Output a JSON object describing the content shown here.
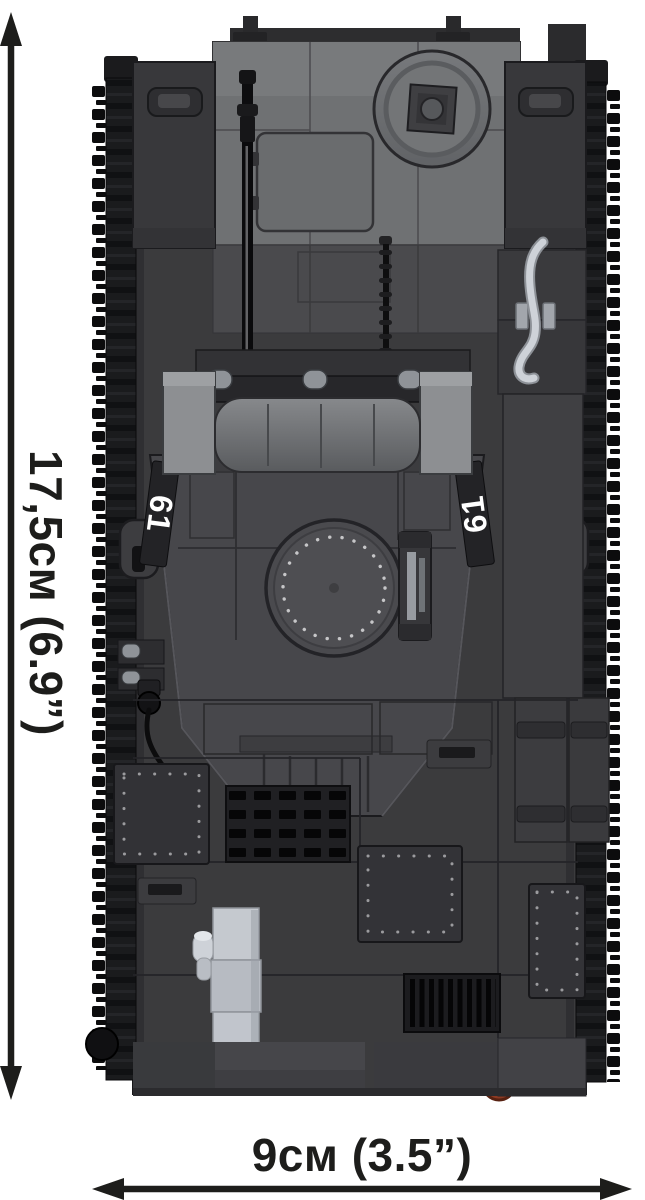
{
  "figure": {
    "turret_marking": "61"
  },
  "dimensions": {
    "height": {
      "label": "17,5см (6.9”)"
    },
    "width": {
      "label": "9см (3.5”)"
    }
  },
  "colors": {
    "background": "#ffffff",
    "annotation": "#1d1d1b",
    "hull": "#3b3b3d",
    "hull_panel_light": "#6f7173",
    "turret": "#47474b",
    "track": "#1a1b1d",
    "tool_silver": "#ced2d8",
    "exhaust_silver": "#c5c9cf",
    "muffler_rust": "#8c3a23",
    "decal_text": "#ffffff"
  }
}
